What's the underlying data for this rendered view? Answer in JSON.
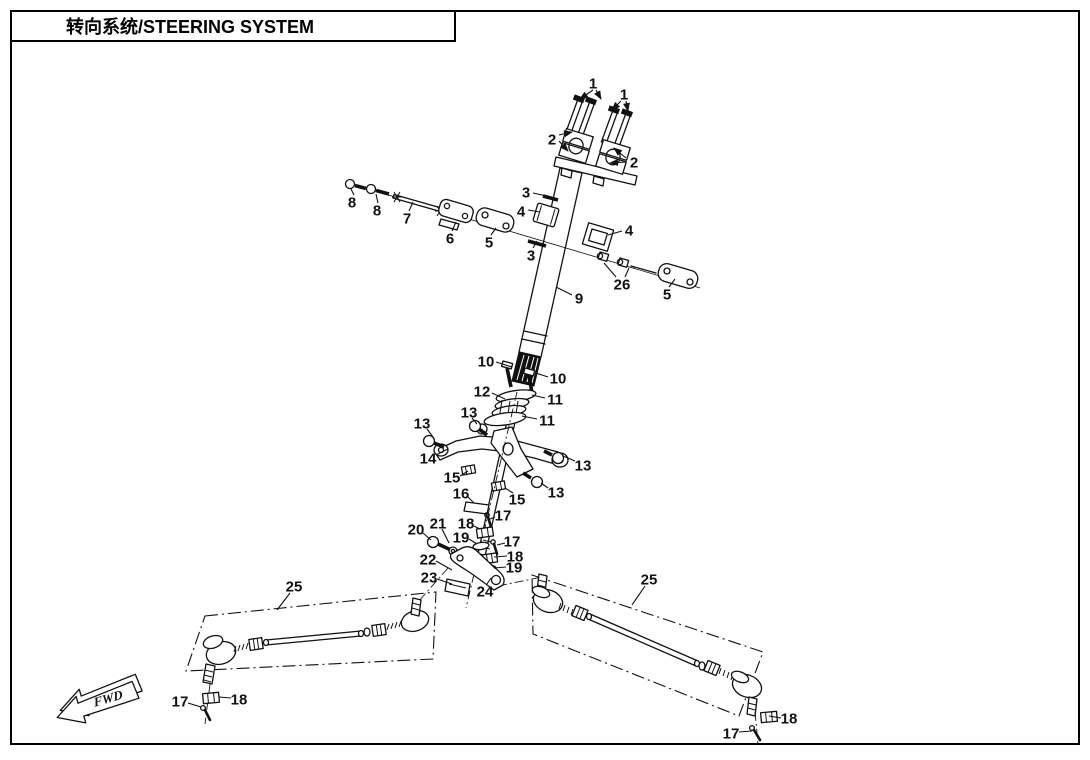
{
  "title_block": {
    "title": "转向系统/STEERING SYSTEM"
  },
  "direction_marker": {
    "label": "FWD"
  },
  "diagram": {
    "description_parts_shown": [
      "1",
      "2",
      "3",
      "4",
      "5",
      "6",
      "7",
      "8",
      "9",
      "10",
      "11",
      "12",
      "13",
      "14",
      "15",
      "16",
      "17",
      "18",
      "19",
      "20",
      "21",
      "22",
      "23",
      "24",
      "25",
      "26"
    ],
    "callouts": [
      {
        "n": "1",
        "x": 593,
        "y": 83,
        "arrow": true,
        "leaders": [
          [
            593,
            90,
            580,
            99
          ],
          [
            596,
            90,
            601,
            99
          ]
        ]
      },
      {
        "n": "1",
        "x": 624,
        "y": 94,
        "arrow": true,
        "leaders": [
          [
            621,
            101,
            612,
            110
          ],
          [
            626,
            101,
            628,
            111
          ]
        ]
      },
      {
        "n": "2",
        "x": 552,
        "y": 139,
        "arrow": true,
        "leaders": [
          [
            559,
            135,
            572,
            132
          ],
          [
            559,
            141,
            568,
            151
          ]
        ]
      },
      {
        "n": "2",
        "x": 634,
        "y": 162,
        "arrow": true,
        "leaders": [
          [
            626,
            158,
            614,
            148
          ],
          [
            626,
            162,
            610,
            163
          ]
        ]
      },
      {
        "n": "3",
        "x": 526,
        "y": 192,
        "leaders": [
          [
            533,
            193,
            551,
            197
          ]
        ]
      },
      {
        "n": "4",
        "x": 521,
        "y": 211,
        "leaders": [
          [
            528,
            210,
            540,
            212
          ]
        ]
      },
      {
        "n": "3",
        "x": 531,
        "y": 255,
        "leaders": [
          [
            533,
            248,
            537,
            241
          ]
        ]
      },
      {
        "n": "4",
        "x": 629,
        "y": 230,
        "leaders": [
          [
            622,
            231,
            608,
            235
          ]
        ]
      },
      {
        "n": "26",
        "x": 622,
        "y": 284,
        "leaders": [
          [
            616,
            277,
            604,
            263
          ],
          [
            625,
            277,
            629,
            268
          ]
        ]
      },
      {
        "n": "5",
        "x": 489,
        "y": 242,
        "leaders": [
          [
            491,
            235,
            496,
            228
          ]
        ]
      },
      {
        "n": "5",
        "x": 667,
        "y": 294,
        "leaders": [
          [
            669,
            287,
            675,
            279
          ]
        ]
      },
      {
        "n": "6",
        "x": 450,
        "y": 238,
        "leaders": [
          [
            452,
            231,
            456,
            222
          ]
        ]
      },
      {
        "n": "7",
        "x": 407,
        "y": 218,
        "leaders": [
          [
            409,
            211,
            413,
            202
          ]
        ]
      },
      {
        "n": "8",
        "x": 352,
        "y": 202,
        "leaders": [
          [
            354,
            195,
            351,
            189
          ]
        ]
      },
      {
        "n": "8",
        "x": 377,
        "y": 210,
        "leaders": [
          [
            378,
            203,
            376,
            194
          ]
        ]
      },
      {
        "n": "9",
        "x": 579,
        "y": 298,
        "leaders": [
          [
            572,
            295,
            556,
            287
          ]
        ]
      },
      {
        "n": "10",
        "x": 486,
        "y": 361,
        "leaders": [
          [
            496,
            362,
            512,
            367
          ]
        ]
      },
      {
        "n": "10",
        "x": 558,
        "y": 378,
        "leaders": [
          [
            548,
            377,
            536,
            373
          ]
        ]
      },
      {
        "n": "11",
        "x": 555,
        "y": 399,
        "leaders": [
          [
            545,
            398,
            532,
            395
          ]
        ]
      },
      {
        "n": "11",
        "x": 547,
        "y": 420,
        "leaders": [
          [
            537,
            419,
            522,
            416
          ]
        ]
      },
      {
        "n": "12",
        "x": 482,
        "y": 391,
        "leaders": [
          [
            492,
            393,
            505,
            399
          ]
        ]
      },
      {
        "n": "13",
        "x": 422,
        "y": 423,
        "leaders": [
          [
            427,
            429,
            433,
            437
          ]
        ]
      },
      {
        "n": "13",
        "x": 469,
        "y": 412,
        "leaders": [
          [
            472,
            418,
            477,
            424
          ]
        ]
      },
      {
        "n": "13",
        "x": 583,
        "y": 465,
        "leaders": [
          [
            575,
            461,
            563,
            456
          ]
        ]
      },
      {
        "n": "13",
        "x": 556,
        "y": 492,
        "leaders": [
          [
            548,
            488,
            541,
            483
          ]
        ]
      },
      {
        "n": "14",
        "x": 428,
        "y": 458,
        "leaders": [
          [
            436,
            455,
            448,
            449
          ]
        ]
      },
      {
        "n": "15",
        "x": 452,
        "y": 477,
        "leaders": [
          [
            460,
            476,
            468,
            471
          ]
        ]
      },
      {
        "n": "15",
        "x": 517,
        "y": 499,
        "leaders": [
          [
            513,
            493,
            505,
            488
          ]
        ]
      },
      {
        "n": "16",
        "x": 461,
        "y": 493,
        "leaders": [
          [
            468,
            497,
            474,
            503
          ]
        ]
      },
      {
        "n": "17",
        "x": 503,
        "y": 515,
        "leaders": [
          [
            495,
            517,
            490,
            519
          ]
        ]
      },
      {
        "n": "17",
        "x": 512,
        "y": 541,
        "leaders": [
          [
            505,
            543,
            497,
            545
          ]
        ]
      },
      {
        "n": "18",
        "x": 466,
        "y": 523,
        "leaders": [
          [
            474,
            526,
            480,
            529
          ]
        ]
      },
      {
        "n": "18",
        "x": 515,
        "y": 556,
        "leaders": [
          [
            507,
            556,
            494,
            557
          ]
        ]
      },
      {
        "n": "19",
        "x": 461,
        "y": 537,
        "leaders": [
          [
            469,
            539,
            477,
            544
          ]
        ]
      },
      {
        "n": "19",
        "x": 514,
        "y": 567,
        "leaders": [
          [
            506,
            567,
            494,
            568
          ]
        ]
      },
      {
        "n": "20",
        "x": 416,
        "y": 529,
        "leaders": [
          [
            423,
            533,
            431,
            540
          ]
        ]
      },
      {
        "n": "21",
        "x": 438,
        "y": 523,
        "leaders": [
          [
            442,
            529,
            449,
            543
          ]
        ]
      },
      {
        "n": "22",
        "x": 428,
        "y": 559,
        "leaders": [
          [
            436,
            561,
            452,
            570
          ]
        ]
      },
      {
        "n": "23",
        "x": 429,
        "y": 577,
        "leaders": [
          [
            437,
            579,
            452,
            584
          ]
        ]
      },
      {
        "n": "24",
        "x": 485,
        "y": 591,
        "leaders": [
          [
            487,
            584,
            491,
            578
          ]
        ]
      },
      {
        "n": "25",
        "x": 294,
        "y": 586,
        "leaders": [
          [
            290,
            593,
            277,
            610
          ]
        ]
      },
      {
        "n": "25",
        "x": 649,
        "y": 579,
        "leaders": [
          [
            645,
            586,
            632,
            605
          ]
        ]
      },
      {
        "n": "17",
        "x": 180,
        "y": 701,
        "leaders": [
          [
            188,
            703,
            201,
            707
          ]
        ]
      },
      {
        "n": "18",
        "x": 239,
        "y": 699,
        "leaders": [
          [
            231,
            698,
            219,
            697
          ]
        ]
      },
      {
        "n": "17",
        "x": 731,
        "y": 733,
        "leaders": [
          [
            739,
            732,
            752,
            731
          ]
        ]
      },
      {
        "n": "18",
        "x": 789,
        "y": 718,
        "leaders": [
          [
            781,
            718,
            769,
            716
          ]
        ]
      }
    ]
  }
}
